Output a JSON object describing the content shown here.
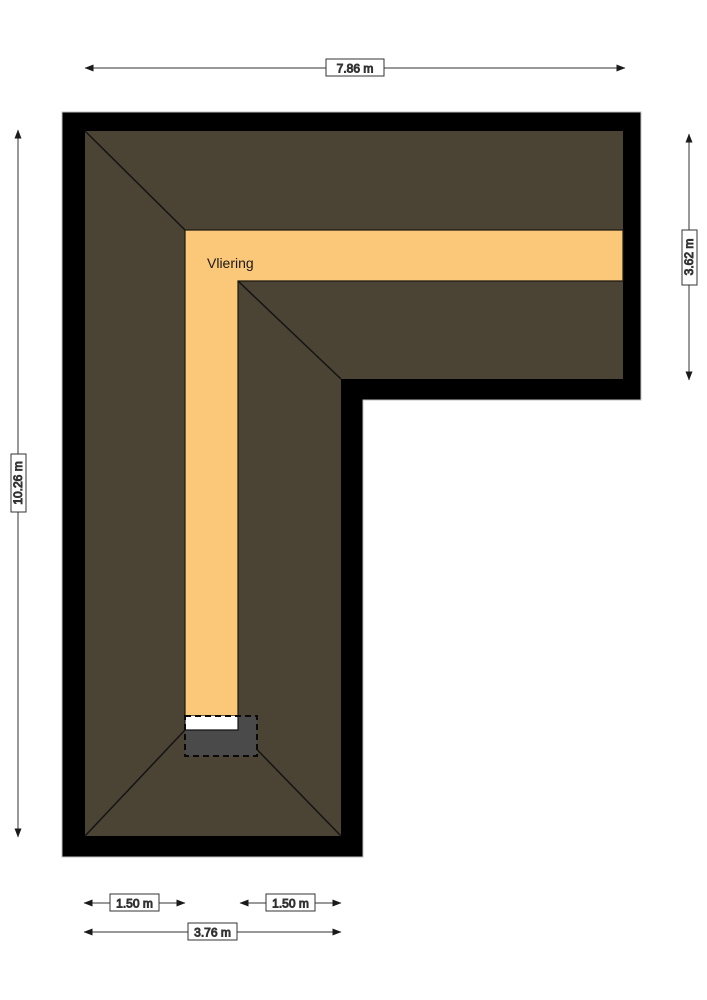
{
  "plan": {
    "room": {
      "label": "Vliering"
    },
    "dimensions": {
      "top": "7.86 m",
      "left": "10.26 m",
      "right": "3.62 m",
      "bottom_left": "1.50 m",
      "bottom_right": "1.50 m",
      "bottom_total": "3.76 m"
    },
    "colors": {
      "wall": "#000000",
      "roof": "#4b4334",
      "floor": "#fbc778",
      "stair_opening": "#4a4a4a",
      "opening_strip": "#ffffff",
      "dimension_line": "#333333",
      "background": "#ffffff"
    }
  }
}
